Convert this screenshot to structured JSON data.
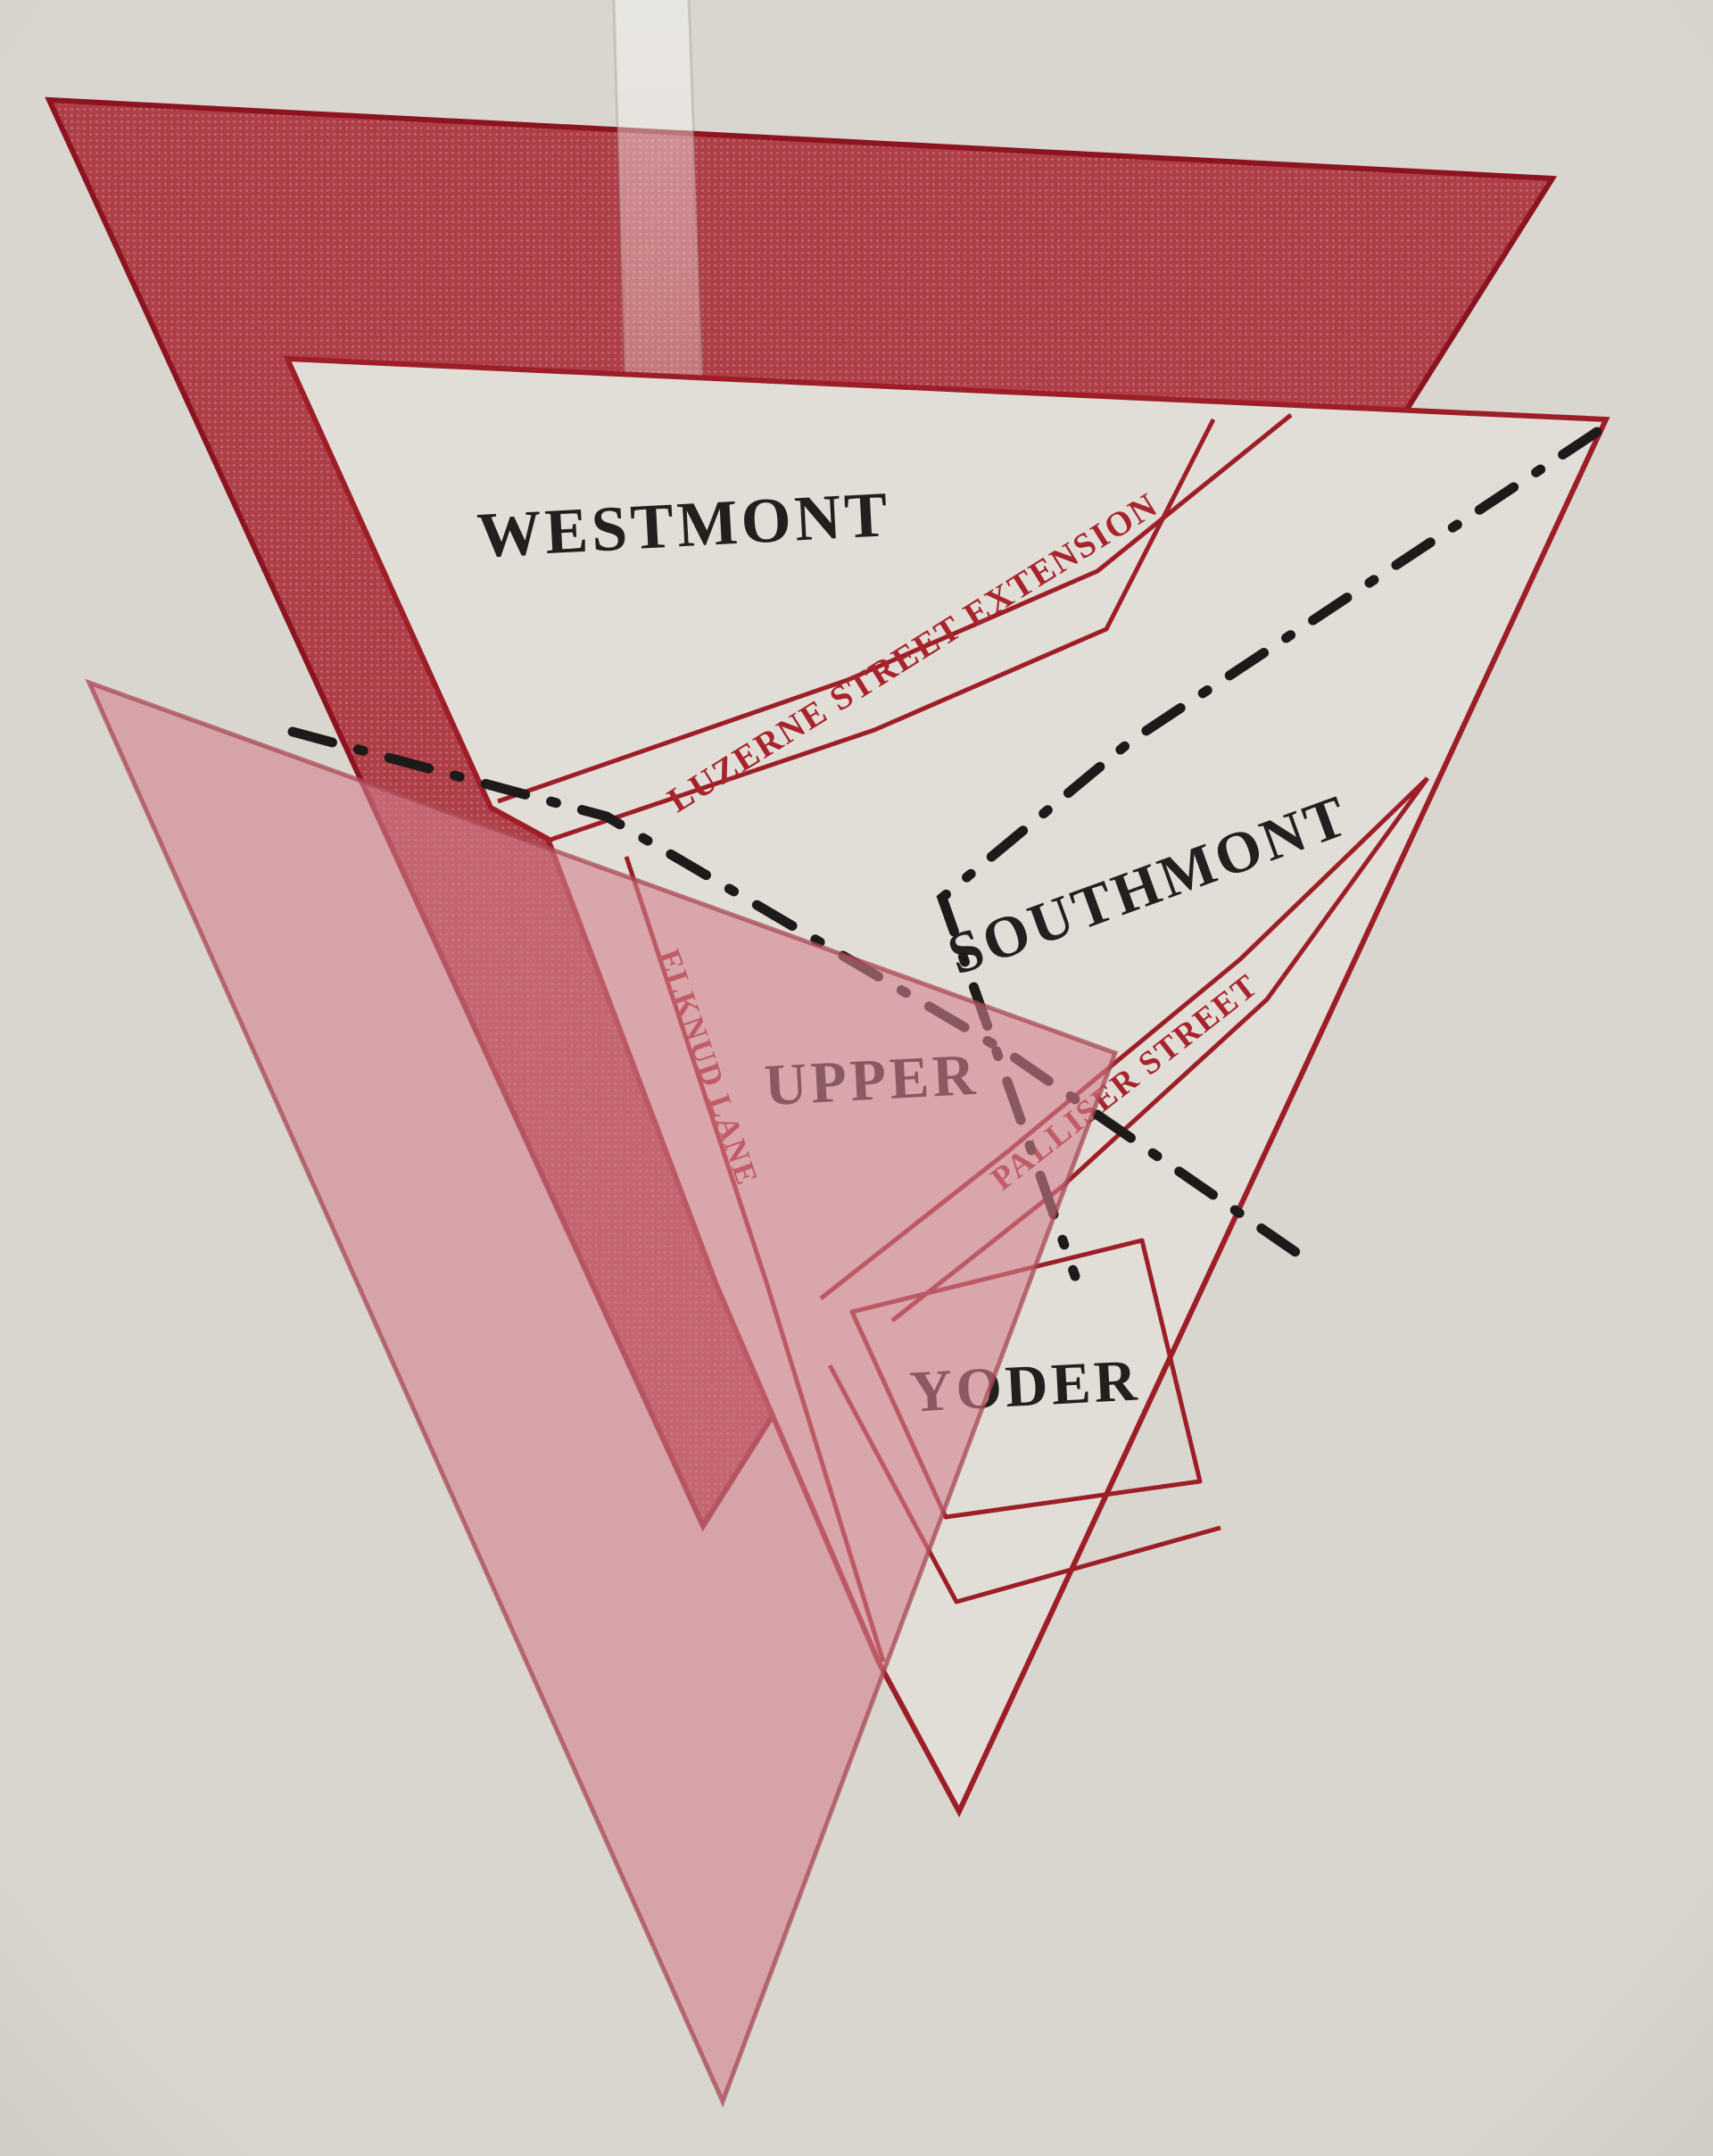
{
  "map": {
    "title_hint": "printed map of hilltop boroughs rendered as overlapping triangles",
    "regions": [
      {
        "id": "westmont",
        "label": "WESTMONT"
      },
      {
        "id": "southmont",
        "label": "SOUTHMONT"
      },
      {
        "id": "upper",
        "label": "UPPER"
      },
      {
        "id": "yoder",
        "label": "YODER"
      }
    ],
    "streets": [
      {
        "id": "luzerne",
        "label": "LUZERNE STREET EXTENSION"
      },
      {
        "id": "palliser",
        "label": "PALLISER STREET"
      },
      {
        "id": "elknud",
        "label": "ELKNUD LANE"
      }
    ],
    "colors": {
      "paper": "#d9d6d0",
      "map_interior": "#e1ded8",
      "dark_red_fill": "#ae3f49",
      "dark_red_dot": "#c2636c",
      "dark_red_edge": "#8c1420",
      "pink_fill": "#d2808d",
      "pink_edge": "#a84853",
      "outline_red": "#9e1e28",
      "boundary_black": "#1d1a19",
      "region_label_black": "#221f1f",
      "street_label_red": "#a8242c"
    }
  }
}
